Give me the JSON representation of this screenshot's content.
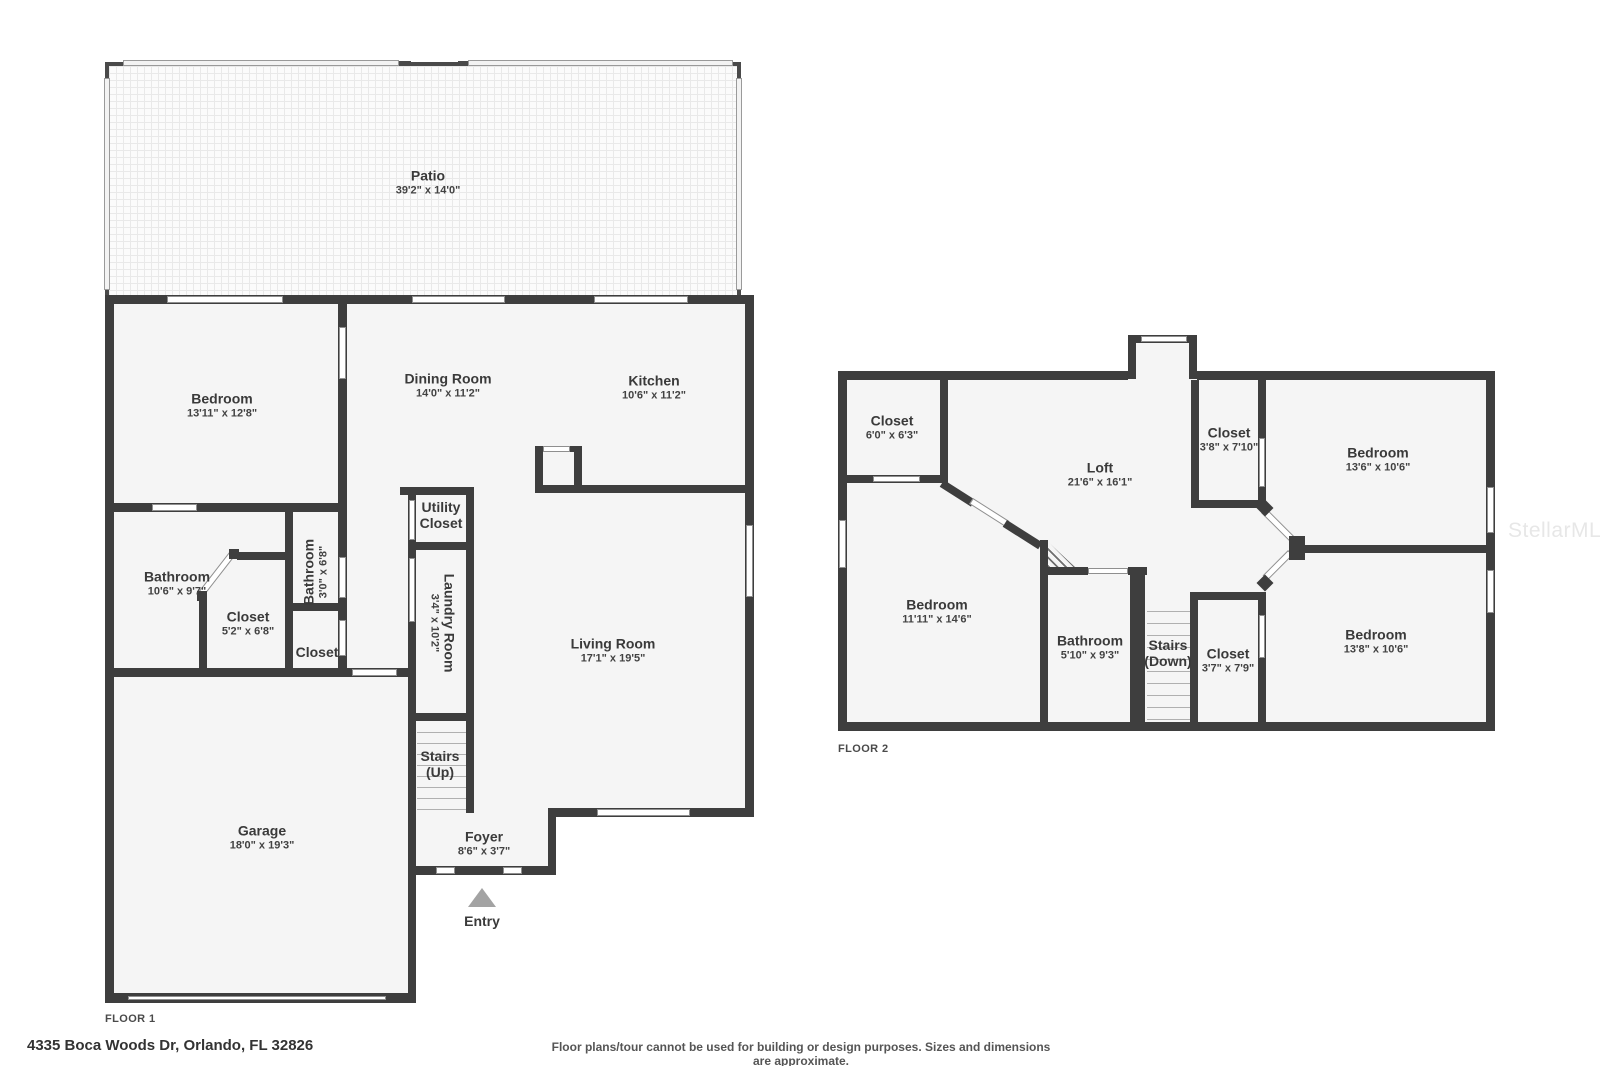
{
  "watermark": "StellarMLS",
  "footer": {
    "address": "4335 Boca Woods Dr, Orlando, FL 32826",
    "disclaimer": "Floor plans/tour cannot be used for building or design purposes. Sizes and dimensions are approximate."
  },
  "floor1": {
    "label": "FLOOR 1",
    "rooms": {
      "patio": {
        "name": "Patio",
        "dims": "39'2\" x 14'0\""
      },
      "bedroom": {
        "name": "Bedroom",
        "dims": "13'11\" x 12'8\""
      },
      "dining": {
        "name": "Dining Room",
        "dims": "14'0\" x 11'2\""
      },
      "kitchen": {
        "name": "Kitchen",
        "dims": "10'6\" x 11'2\""
      },
      "bathroom": {
        "name": "Bathroom",
        "dims": "10'6\" x 9'7\""
      },
      "closet": {
        "name": "Closet",
        "dims": "5'2\" x 6'8\""
      },
      "bathroom2": {
        "name": "Bathroom",
        "dims": "3'0\" x 6'8\""
      },
      "closet2": {
        "name": "Closet"
      },
      "utility": {
        "line1": "Utility",
        "line2": "Closet"
      },
      "laundry": {
        "name": "Laundry Room",
        "dims": "3'4\" x 10'2\""
      },
      "living": {
        "name": "Living Room",
        "dims": "17'1\" x 19'5\""
      },
      "stairs": {
        "name": "Stairs",
        "dir": "(Up)"
      },
      "garage": {
        "name": "Garage",
        "dims": "18'0\" x 19'3\""
      },
      "foyer": {
        "name": "Foyer",
        "dims": "8'6\" x 3'7\""
      },
      "entry": {
        "name": "Entry"
      }
    }
  },
  "floor2": {
    "label": "FLOOR 2",
    "rooms": {
      "closet_tl": {
        "name": "Closet",
        "dims": "6'0\" x 6'3\""
      },
      "loft": {
        "name": "Loft",
        "dims": "21'6\" x 16'1\""
      },
      "closet_tr": {
        "name": "Closet",
        "dims": "3'8\" x 7'10\""
      },
      "bedroom_tr": {
        "name": "Bedroom",
        "dims": "13'6\" x 10'6\""
      },
      "bedroom_l": {
        "name": "Bedroom",
        "dims": "11'11\" x 14'6\""
      },
      "bathroom": {
        "name": "Bathroom",
        "dims": "5'10\" x 9'3\""
      },
      "stairs": {
        "name": "Stairs",
        "dir": "(Down)"
      },
      "closet_b": {
        "name": "Closet",
        "dims": "3'7\" x 7'9\""
      },
      "bedroom_br": {
        "name": "Bedroom",
        "dims": "13'8\" x 10'6\""
      }
    }
  }
}
